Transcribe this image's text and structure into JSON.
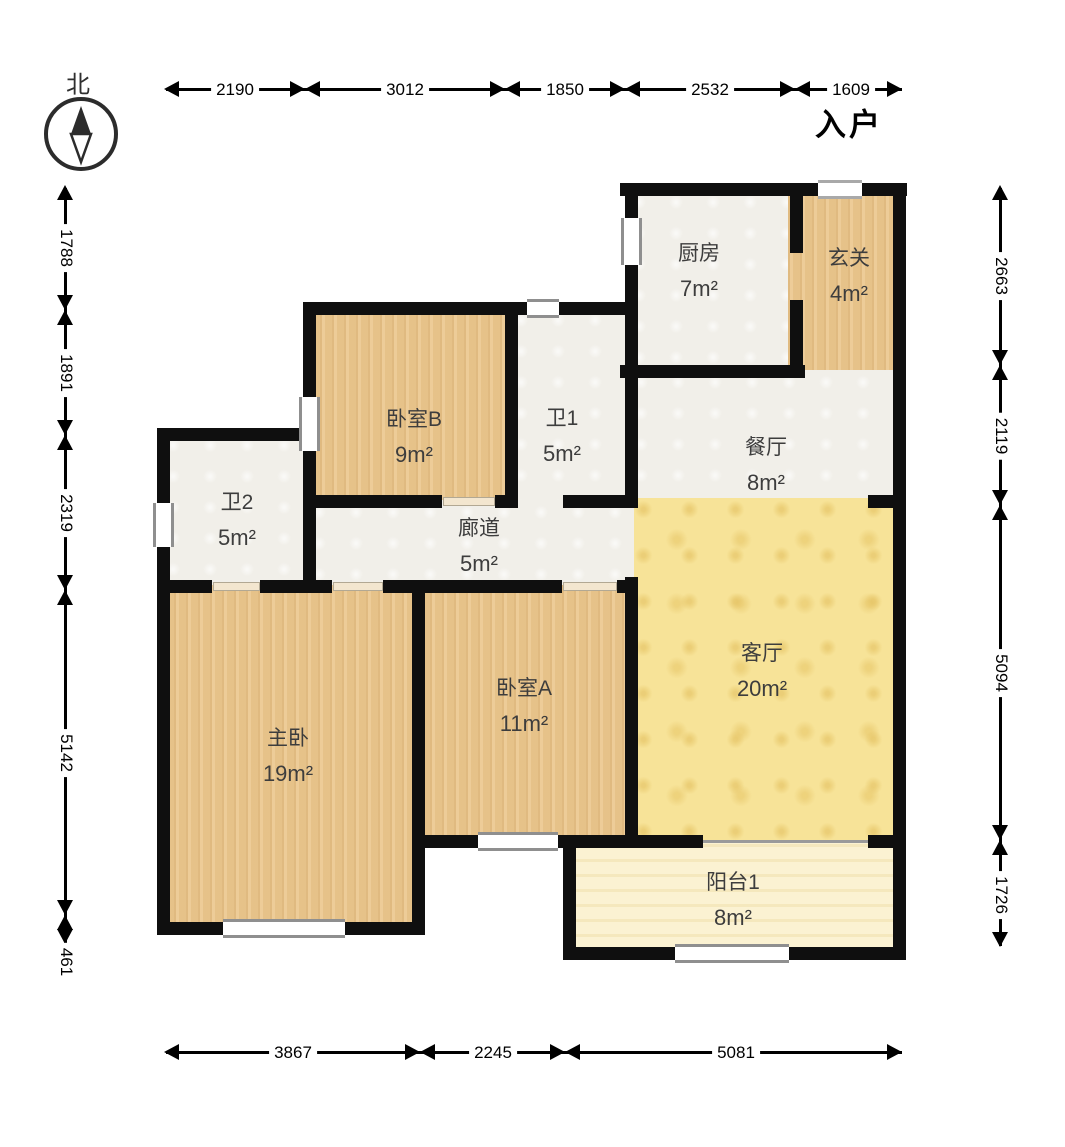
{
  "compass": {
    "north_label": "北"
  },
  "entrance_label": "入户",
  "rooms": {
    "kitchen": {
      "name": "厨房",
      "area": "7m²"
    },
    "foyer": {
      "name": "玄关",
      "area": "4m²"
    },
    "bedroomB": {
      "name": "卧室B",
      "area": "9m²"
    },
    "bath1": {
      "name": "卫1",
      "area": "5m²"
    },
    "dining": {
      "name": "餐厅",
      "area": "8m²"
    },
    "bath2": {
      "name": "卫2",
      "area": "5m²"
    },
    "corridor": {
      "name": "廊道",
      "area": "5m²"
    },
    "living": {
      "name": "客厅",
      "area": "20m²"
    },
    "master": {
      "name": "主卧",
      "area": "19m²"
    },
    "bedroomA": {
      "name": "卧室A",
      "area": "11m²"
    },
    "balcony": {
      "name": "阳台1",
      "area": "8m²"
    }
  },
  "dimensions": {
    "top": [
      "2190",
      "3012",
      "1850",
      "2532",
      "1609"
    ],
    "bottom": [
      "3867",
      "2245",
      "5081"
    ],
    "left": [
      "1788",
      "1891",
      "2319",
      "5142",
      "461"
    ],
    "right": [
      "2663",
      "2119",
      "5094",
      "1726"
    ]
  },
  "colors": {
    "wall": "#0f0f0f",
    "wood_floor": "#ebc78e",
    "living_floor": "#f7e398",
    "balcony_floor": "#fbf2d2",
    "white_floor": "#f1efe9",
    "dimension": "#000000",
    "room_label": "#3d3d3d"
  }
}
